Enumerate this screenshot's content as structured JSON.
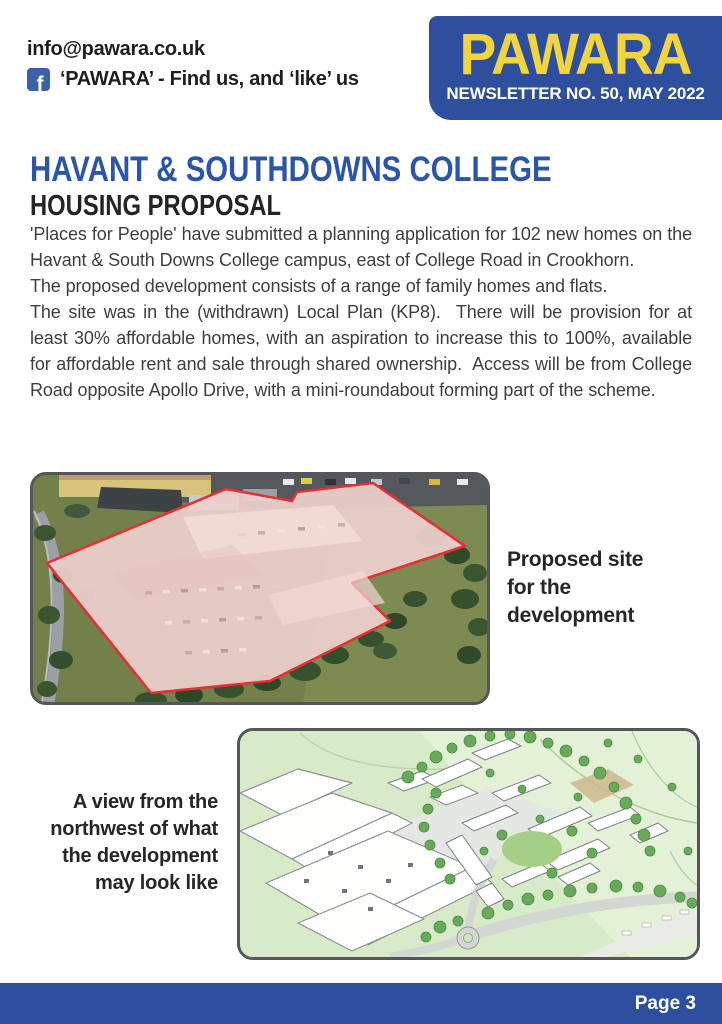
{
  "header": {
    "email": "info@pawara.co.uk",
    "facebook_icon_letter": "f",
    "facebook_line": "‘PAWARA’ - Find us, and ‘like’ us",
    "masthead_title": "PAWARA",
    "masthead_subtitle": "NEWSLETTER NO. 50, MAY 2022"
  },
  "article": {
    "title": "HAVANT & SOUTHDOWNS COLLEGE",
    "subtitle": "HOUSING PROPOSAL",
    "paragraphs": [
      "'Places for People' have submitted a planning application for 102 new homes on the Havant & South Downs College campus, east of College Road in Crookhorn.",
      "The proposed development consists of a range of family homes and flats.",
      "The site was in the (withdrawn) Local Plan (KP8).  There will be provision for at least 30% affordable homes, with an aspiration to increase this to 100%, available for affordable rent and sale through shared ownership.  Access will be from College Road opposite Apollo Drive, with a mini-roundabout forming part of the scheme."
    ]
  },
  "figures": [
    {
      "image": "aerial-photo-of-proposed-site",
      "caption": "Proposed site for the development"
    },
    {
      "image": "artist-impression-of-development",
      "caption": "A view from the northwest of what the development may look like"
    }
  ],
  "footer": {
    "page_label": "Page 3"
  },
  "colors": {
    "brand_blue": "#2e4f9e",
    "brand_yellow": "#f2d53e",
    "heading_blue": "#2b55a8",
    "site_outline_red": "#e62e33",
    "facebook_blue": "#3b62a9"
  }
}
